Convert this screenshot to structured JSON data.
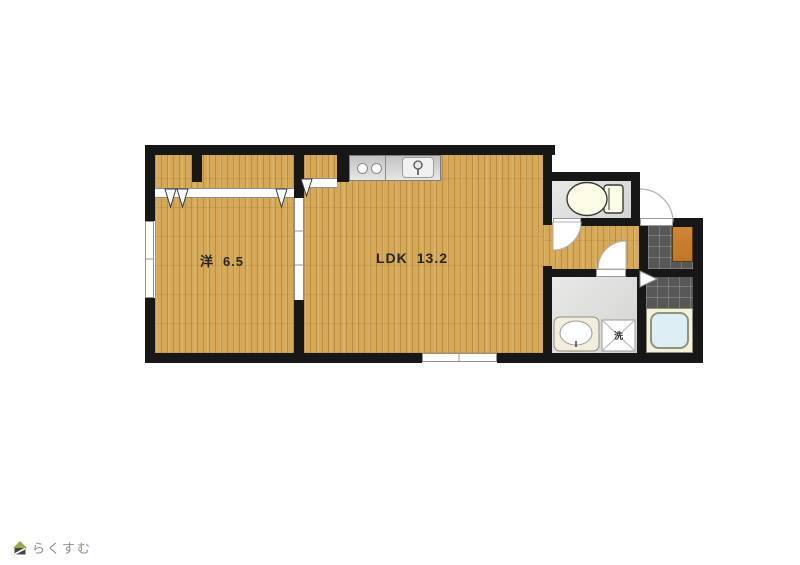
{
  "canvas": {
    "width": 800,
    "height": 565,
    "background": "#ffffff"
  },
  "floorplan": {
    "rooms": {
      "western": {
        "label": "洋",
        "area": "6.5"
      },
      "ldk": {
        "label": "LDK",
        "area": "13.2"
      }
    },
    "fixtures": {
      "washer_pan_label": "洗"
    },
    "colors": {
      "wall": "#171717",
      "wood_floor": "#d5a958",
      "wood_grain": "#b98f3e",
      "service_floor_gray": "#dcdcda",
      "entrance_tile_dark": "#575757",
      "shoe_cabinet_orange": "#c8802f",
      "bathtub_blue": "#ddeef4",
      "bath_surround_cream": "#f5f0da",
      "kitchen_counter_gray": "#d4d4d4"
    },
    "icons": [
      "toilet-icon",
      "washbasin-icon",
      "washing-machine-icon",
      "bathtub-icon",
      "stove-burners-icon",
      "kitchen-sink-icon",
      "faucet-icon",
      "entry-door-arc-icon",
      "door-swing-arc-icon",
      "folding-door-triangle-icon",
      "shoe-cabinet"
    ]
  },
  "logo": {
    "text": "らくすむ",
    "color": "#948b81",
    "icon": "house-logo-icon"
  }
}
